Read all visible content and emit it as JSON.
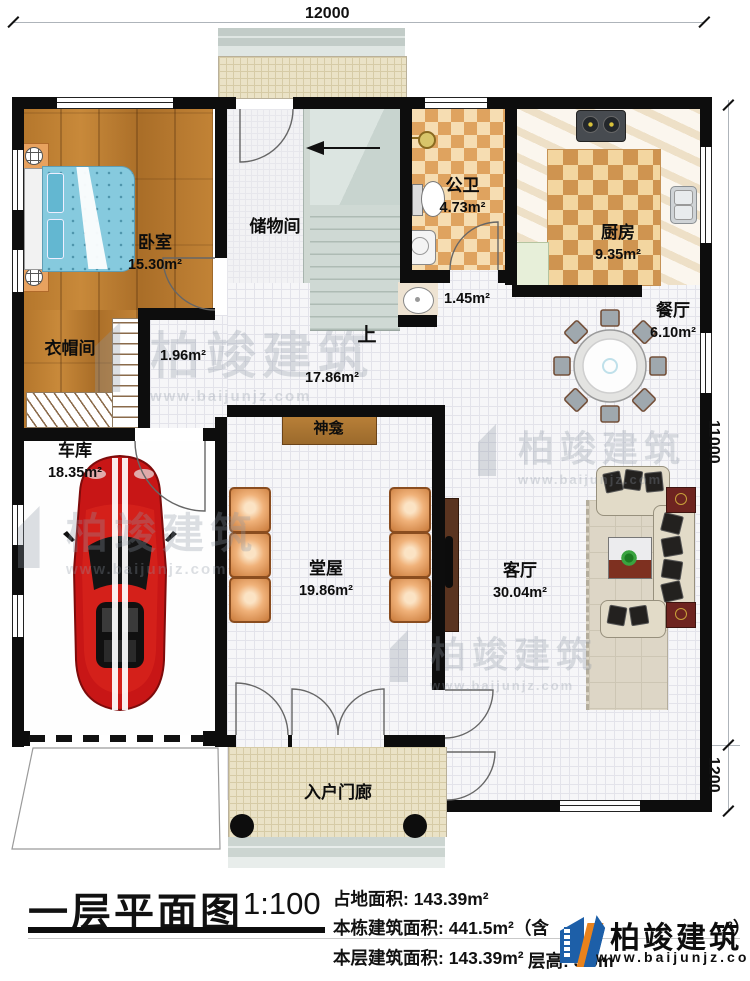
{
  "dimensions": {
    "top": "12000",
    "right_upper": "11000",
    "right_lower": "1200"
  },
  "rooms": {
    "bedroom": {
      "name": "卧室",
      "area": "15.30m²"
    },
    "cloakroom": {
      "name": "衣帽间"
    },
    "corridor": {
      "area": "1.96m²"
    },
    "storage": {
      "name": "储物间"
    },
    "stairs": {
      "up_label": "上"
    },
    "bathroom": {
      "name": "公卫",
      "area": "4.73m²"
    },
    "basin_nook": {
      "area": "1.45m²"
    },
    "kitchen": {
      "name": "厨房",
      "area": "9.35m²"
    },
    "dining": {
      "name": "餐厅",
      "area": "6.10m²"
    },
    "hall": {
      "area": "17.86m²"
    },
    "garage": {
      "name": "车库",
      "area": "18.35m²"
    },
    "main_hall": {
      "name": "堂屋",
      "area": "19.86m²"
    },
    "shrine": {
      "name": "神龛"
    },
    "living": {
      "name": "客厅",
      "area": "30.04m²"
    },
    "porch": {
      "name": "入户门廊"
    }
  },
  "title_block": {
    "title": "一层平面图",
    "scale": "1:100",
    "line1": "占地面积: 143.39m²",
    "line2_prefix": "本栋建筑面积: 441.5m²（含",
    "line2_suffix": "²）",
    "line3a": "本层建筑面积: 143.39m²",
    "line3b": "层高: 3.0m"
  },
  "brand": {
    "name": "柏竣建筑",
    "website": "www.baijunjz.com"
  },
  "watermark": {
    "name": "柏竣建筑",
    "website": "www.baijunjz.com"
  },
  "colors": {
    "wall": "#0d0d0d",
    "wood": "#b5772c",
    "checker": "#dfa35f",
    "car_red": "#c81616",
    "brand_blue": "#1d5fa8",
    "brand_orange": "#e8821c"
  }
}
